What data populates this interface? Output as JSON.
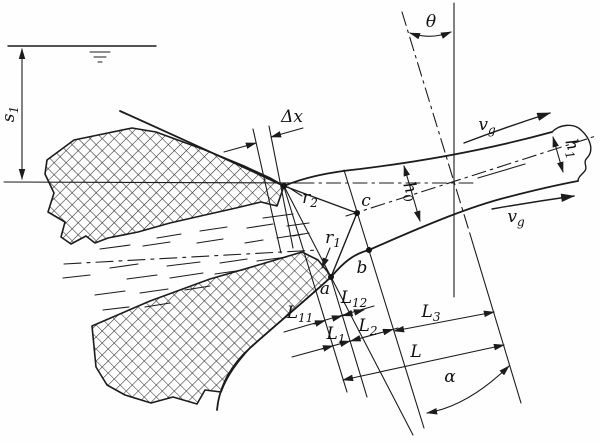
{
  "figure": {
    "description": "Hydraulic diagram of flow under a curved gate: jet issuing between cross-hatched gate body and sill, with contraction sections and length dimensions",
    "colors": {
      "paper": "#fefefe",
      "ink": "#1c1c1c"
    }
  },
  "labels": {
    "s1": {
      "base": "s",
      "sub": "1"
    },
    "delta_x": {
      "base": "Δx",
      "sub": ""
    },
    "r2": {
      "base": "r",
      "sub": "2"
    },
    "r1": {
      "base": "r",
      "sub": "1"
    },
    "point_a": {
      "base": "a",
      "sub": ""
    },
    "point_b": {
      "base": "b",
      "sub": ""
    },
    "point_c": {
      "base": "c",
      "sub": ""
    },
    "h0": {
      "base": "h",
      "sub": "0"
    },
    "h1": {
      "base": "h",
      "sub": "1"
    },
    "vg_top": {
      "base": "v",
      "sub": "g"
    },
    "vg_bottom": {
      "base": "v",
      "sub": "g"
    },
    "L11": {
      "base": "L",
      "sub": "11"
    },
    "L12": {
      "base": "L",
      "sub": "12"
    },
    "L1": {
      "base": "L",
      "sub": "1"
    },
    "L2": {
      "base": "L",
      "sub": "2"
    },
    "L3": {
      "base": "L",
      "sub": "3"
    },
    "L": {
      "base": "L",
      "sub": ""
    },
    "alpha": {
      "base": "α",
      "sub": ""
    },
    "theta": {
      "base": "θ",
      "sub": ""
    }
  }
}
